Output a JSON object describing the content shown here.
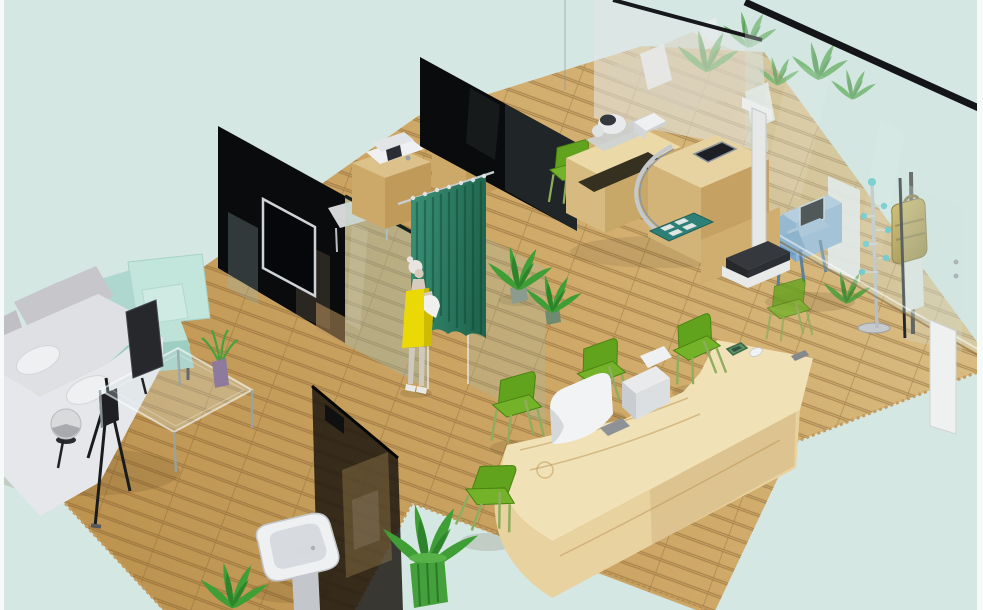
{
  "meta": {
    "type": "3d-rendered-interior",
    "description": "Isometric 3D rendering of a clinic interior: wooden parquet floor, grey sofa and teal armchair waiting corner with glass coffee table, black partition wall with TV, teal changing curtain with a mannequin in a yellow dress, wooden cabinets with medical devices, long wooden reception counter with white monitors and green chairs, examination desk with stadiometer and scale, blue kiosk machine, coat rack, gold wall dispenser behind a glass wall, pedestal sink and potted plants, on a pale blue background."
  },
  "palette": {
    "bg": "#d5e7e3",
    "page_border": "#f6fbf9",
    "floor_light": "#dcc189",
    "floor_dark": "#bd9350",
    "plank": "#7c5c28",
    "wall_black": "#0a0b0d",
    "glass_tint": "#9bc0ba",
    "glass_partition_dark": "#1c160e",
    "curtain": "#2f8a6e",
    "curtain_dark": "#1e6750",
    "cabinet_top": "#dcc18b",
    "cabinet_front": "#cda969",
    "cabinet_side": "#c09a58",
    "desk_top": "#ecd9a8",
    "desk_front": "#d6ba80",
    "desk_side": "#c8a869",
    "reception_top": "#f0e2b6",
    "reception_front": "#e8d2a0",
    "reception_side": "#d9bd85",
    "chair_green": "#61a31d",
    "chair_green_seat": "#74b22a",
    "chair_green_dark": "#4c8312",
    "chair_leg": "#8fad5e",
    "sofa_grey": "#c6c6cb",
    "sofa_light": "#e6e7ea",
    "sofa_seat": "#dfe0e3",
    "armchair_teal": "#c2e5dc",
    "armchair_teal_dark": "#9ecdc2",
    "device_white": "#eef0f1",
    "device_grey": "#c9ccd0",
    "screen_black": "#15171c",
    "kiosk_blue": "#8fb4d4",
    "kiosk_blue_dark": "#7ba6cd",
    "gold": "#b8962e",
    "gold_dark": "#6e5a16",
    "teal_mat": "#2e7f76",
    "plant_green": "#3f9e35",
    "plant_dark": "#2b7f28",
    "pot_green": "#44a03b",
    "vase_purple": "#8d7a9c",
    "skin": "#d9cbbc",
    "hair": "#e8e4df",
    "dress_yellow": "#ead906",
    "metal": "#c4c9cd",
    "scale_dark": "#35383c"
  },
  "scene": {
    "background_color": "#d5e7e3",
    "objects": [
      {
        "name": "wood-parquet-floor",
        "color": "floor_light"
      },
      {
        "name": "waiting-sofa",
        "color": "sofa_grey"
      },
      {
        "name": "armchair",
        "color": "armchair_teal"
      },
      {
        "name": "glass-coffee-table",
        "color": "glass_tint"
      },
      {
        "name": "table-plant-purple-vase",
        "color": "vase_purple"
      },
      {
        "name": "floor-lamp",
        "color": "metal"
      },
      {
        "name": "display-tripod",
        "color": "wall_black"
      },
      {
        "name": "black-partition-wall-left",
        "color": "wall_black"
      },
      {
        "name": "wall-mounted-tv",
        "color": "screen_black"
      },
      {
        "name": "glass-partition",
        "color": "glass_tint"
      },
      {
        "name": "changing-curtain",
        "color": "curtain"
      },
      {
        "name": "mannequin-yellow-dress",
        "color": "dress_yellow"
      },
      {
        "name": "cabinet-with-printer",
        "color": "cabinet_top"
      },
      {
        "name": "cabinet-with-ecg-monitor",
        "color": "cabinet_top"
      },
      {
        "name": "black-partition-wall-center",
        "color": "wall_black"
      },
      {
        "name": "frosted-glass-wall",
        "color": "glass_tint"
      },
      {
        "name": "exam-desk",
        "color": "desk_top"
      },
      {
        "name": "blood-pressure-monitor",
        "color": "device_white"
      },
      {
        "name": "stadiometer-and-scale",
        "color": "scale_dark"
      },
      {
        "name": "teal-floor-mat",
        "color": "teal_mat"
      },
      {
        "name": "reception-counter",
        "color": "reception_top"
      },
      {
        "name": "reception-monitors",
        "color": "device_white"
      },
      {
        "name": "green-visitor-chairs",
        "color": "chair_green"
      },
      {
        "name": "kiosk-machine",
        "color": "kiosk_blue"
      },
      {
        "name": "coat-rack",
        "color": "metal"
      },
      {
        "name": "gold-wall-dispenser",
        "color": "gold"
      },
      {
        "name": "glass-entry-wall",
        "color": "glass_tint"
      },
      {
        "name": "pedestal-sink",
        "color": "device_white"
      },
      {
        "name": "dark-glass-partition",
        "color": "glass_partition_dark"
      },
      {
        "name": "potted-plants",
        "color": "plant_green"
      }
    ]
  }
}
